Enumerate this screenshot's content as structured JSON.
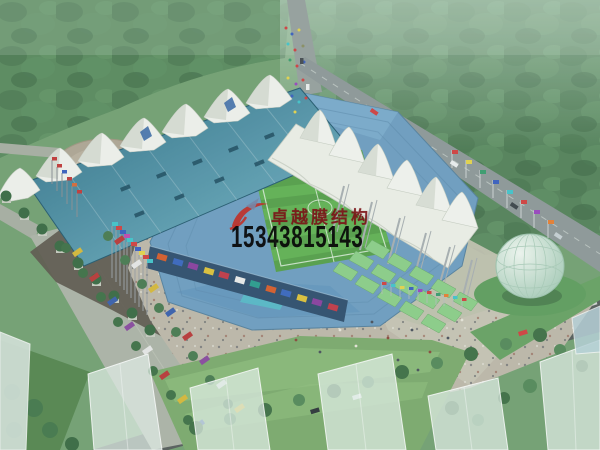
{
  "meta": {
    "type": "architectural-rendering",
    "subject": "Aerial bird's-eye rendering of a stadium with white tensile membrane roof structures, surrounding plazas, roads and landscaping",
    "canvas": {
      "width": 600,
      "height": 450
    }
  },
  "watermark": {
    "company": "卓越膜结构",
    "phone": "15343815143",
    "logo": "red-swoosh-logo",
    "company_color": "#7a1216",
    "phone_color": "#0a0a0a"
  },
  "palette": {
    "forest_green": "#54825a",
    "lawn_green": "#74a173",
    "pitch_green": "#55a04a",
    "pitch_stripe": "#66b957",
    "roof_teal_dark": "#2e6e86",
    "roof_teal_light": "#79b9cb",
    "membrane_white": "#eef0e9",
    "stand_blue": "#6e9ec2",
    "seat_aqua": "#54c4cc",
    "plaza_tan": "#bfb9ab",
    "shadow_gray": "#5d574d",
    "road_gray": "#8e9899",
    "dark_road": "#575d5c",
    "fountain_water": "#6fb2d8",
    "egg_glass": "#cfe4d6",
    "terrace_green": "#8ccf89",
    "flag_red": "#d24040",
    "flag_cyan": "#42c4cc",
    "flag_blue": "#3a5fc0",
    "flag_yellow": "#e6d44c"
  },
  "scene": {
    "elements": [
      "forest",
      "lawns",
      "roads",
      "stadium-bowl",
      "football-pitch",
      "west-stand-teal-roof",
      "membrane-cone-row",
      "east-membrane-canopy",
      "lattice-masts",
      "green-terraces",
      "south-facade-billboards",
      "fountain-plaza",
      "flag-rows",
      "boulevard-parking",
      "glass-egg-pavilion",
      "ghost-buildings",
      "watermark"
    ]
  }
}
